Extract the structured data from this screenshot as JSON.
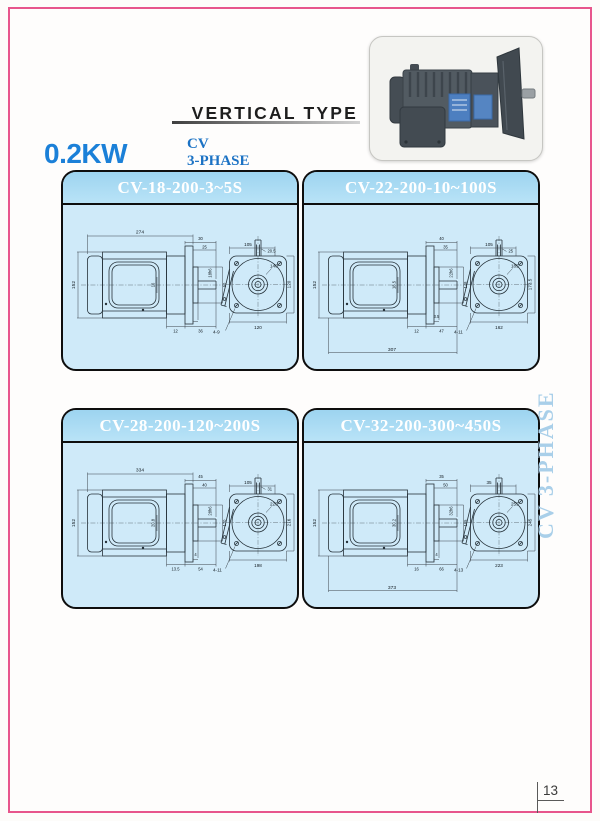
{
  "page": {
    "heading": "VERTICAL TYPE",
    "power": "0.2KW",
    "series_line1": "CV",
    "series_line2": "3-PHASE",
    "side_label": "CV 3-PHASE",
    "page_number": "13",
    "colors": {
      "frame_pink": "#e7558c",
      "panel_header_blue": "#a4d7f1",
      "panel_body_blue": "#cfeaf9",
      "power_blue": "#1b80d8",
      "series_blue": "#1b72c4",
      "side_label_blue": "#a9cfe9"
    }
  },
  "panels": [
    {
      "title": "CV-18-200-3~5S",
      "side": {
        "total": "274",
        "t1": "30",
        "t2": "25",
        "height": "152",
        "mid": "16",
        "shaft_dia": "18h6",
        "right_v": "50",
        "b0": "",
        "b1": "12",
        "b2": "36"
      },
      "front": {
        "top": "105",
        "key": "20.5",
        "dia": "140",
        "right": "120",
        "bottom": "120",
        "holes": "4-9"
      }
    },
    {
      "title": "CV-22-200-10~100S",
      "side": {
        "total": "307",
        "t1": "40",
        "t2": "35",
        "height": "152",
        "mid": "18.5",
        "shaft_dia": "22h6",
        "right_v": "148",
        "b0": "3.5",
        "b1": "12",
        "b2": "47"
      },
      "front": {
        "top": "105",
        "key": "25",
        "dia": "185",
        "right": "173.5",
        "bottom": "162",
        "holes": "4-11"
      }
    },
    {
      "title": "CV-28-200-120~200S",
      "side": {
        "total": "334",
        "t1": "45",
        "t2": "40",
        "height": "152",
        "mid": "20.8",
        "shaft_dia": "28h6",
        "right_v": "170",
        "b0": "4",
        "b1": "13.5",
        "b2": "54"
      },
      "front": {
        "top": "105",
        "key": "31",
        "dia": "220",
        "right": "216",
        "bottom": "198",
        "holes": "4-11"
      }
    },
    {
      "title": "CV-32-200-300~450S",
      "side": {
        "total": "373",
        "t1": "35",
        "t2": "50",
        "height": "152",
        "mid": "30.2",
        "shaft_dia": "32h6",
        "right_v": "185",
        "b0": "4",
        "b1": "16",
        "b2": "66"
      },
      "front": {
        "top": "35",
        "key": "",
        "dia": "255",
        "right": "245",
        "bottom": "223",
        "holes": "4-13"
      }
    }
  ]
}
